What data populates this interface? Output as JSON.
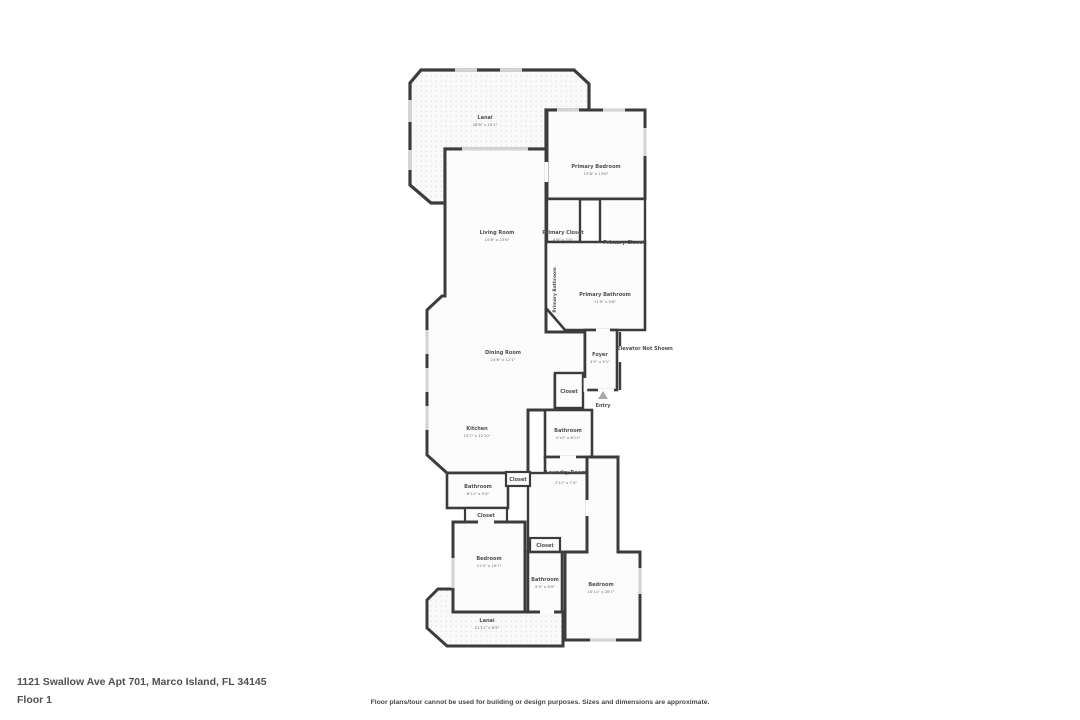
{
  "page": {
    "address": "1121 Swallow Ave Apt 701, Marco Island, FL 34145",
    "floor_label": "Floor 1",
    "disclaimer": "Floor plans/tour cannot be used for building or design purposes. Sizes and dimensions are approximate."
  },
  "colors": {
    "wall": "#3c3c3c",
    "room_fill": "#fcfcfc",
    "lanai_fill": "#fafafa",
    "window": "#d4d4d4",
    "label": "#4e4e4e"
  },
  "floor_plan": {
    "rooms": [
      {
        "name": "Lanai",
        "dims": "28'8\" x 23'1\""
      },
      {
        "name": "Primary Bedroom",
        "dims": "15'8\" x 13'6\""
      },
      {
        "name": "Living Room",
        "dims": "15'8\" x 23'6\""
      },
      {
        "name": "Primary Closet",
        "dims": "4'6\" x 7'0\""
      },
      {
        "name": "Primary Closet",
        "dims": ""
      },
      {
        "name": "Primary Bathroom",
        "dims": "11'9\" x 9'8\""
      },
      {
        "name": "Dining Room",
        "dims": "24'6\" x 12'1\""
      },
      {
        "name": "Foyer",
        "dims": "4'5\" x 9'1\""
      },
      {
        "name": "Elevator Not Shown",
        "dims": ""
      },
      {
        "name": "Entry",
        "dims": ""
      },
      {
        "name": "Closet",
        "dims": ""
      },
      {
        "name": "Kitchen",
        "dims": "15'7\" x 12'10\""
      },
      {
        "name": "Bathroom",
        "dims": "4'10\" x 6'11\""
      },
      {
        "name": "Laundry Room",
        "dims": "2'11\" x 7'4\""
      },
      {
        "name": "Bathroom",
        "dims": "8'11\" x 5'4\""
      },
      {
        "name": "Closet",
        "dims": ""
      },
      {
        "name": "Closet",
        "dims": ""
      },
      {
        "name": "Bedroom",
        "dims": "11'4\" x 19'1\""
      },
      {
        "name": "Closet",
        "dims": ""
      },
      {
        "name": "Bathroom",
        "dims": "5'0\" x 8'9\""
      },
      {
        "name": "Bedroom",
        "dims": "10'11\" x 28'7\""
      },
      {
        "name": "Lanai",
        "dims": "21'11\" x 8'9\""
      }
    ]
  }
}
